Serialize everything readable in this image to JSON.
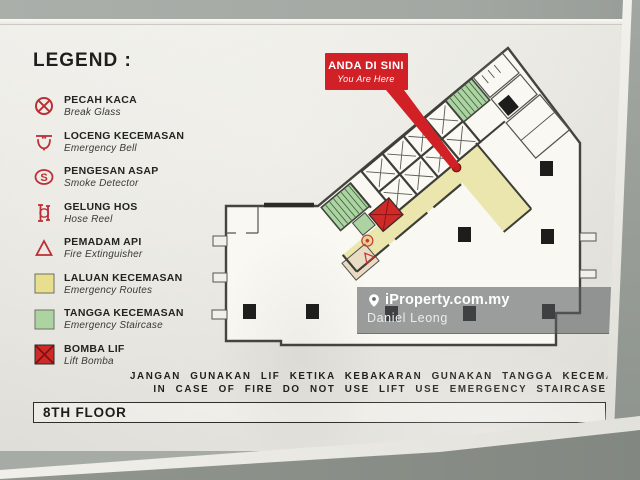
{
  "legend": {
    "heading": "LEGEND :",
    "items": [
      {
        "title": "PECAH KACA",
        "subtitle": "Break Glass",
        "icon": "break-glass-icon"
      },
      {
        "title": "LOCENG KECEMASAN",
        "subtitle": "Emergency Bell",
        "icon": "emergency-bell-icon"
      },
      {
        "title": "PENGESAN ASAP",
        "subtitle": "Smoke Detector",
        "icon": "smoke-detector-icon"
      },
      {
        "title": "GELUNG HOS",
        "subtitle": "Hose Reel",
        "icon": "hose-reel-icon"
      },
      {
        "title": "PEMADAM API",
        "subtitle": "Fire Extinguisher",
        "icon": "fire-extinguisher-icon"
      },
      {
        "title": "LALUAN KECEMASAN",
        "subtitle": "Emergency Routes",
        "icon": "emergency-route-swatch"
      },
      {
        "title": "TANGGA KECEMASAN",
        "subtitle": "Emergency Staircase",
        "icon": "emergency-staircase-swatch"
      },
      {
        "title": "BOMBA LIF",
        "subtitle": "Lift Bomba",
        "icon": "fire-lift-swatch"
      }
    ]
  },
  "callout": {
    "title": "ANDA DI SINI",
    "subtitle": "You Are Here"
  },
  "watermark": {
    "brand": "iProperty.com.my",
    "agent": "Daniel Leong"
  },
  "warning": {
    "line_malay": "JANGAN GUNAKAN LIF KETIKA KEBAKARAN GUNAKAN TANGGA KECEMASAN",
    "line_english": "IN CASE OF FIRE DO NOT USE LIFT USE EMERGENCY STAIRCASE"
  },
  "floor_label": "8TH FLOOR",
  "plan": {
    "type": "floor-plan",
    "features": [
      "lift-bank",
      "emergency-route-corridor",
      "emergency-staircase-upper",
      "emergency-staircase-lower",
      "fire-lift",
      "hose-reel-point",
      "fire-extinguisher-point",
      "you-are-here-marker",
      "structural-columns"
    ]
  },
  "colors": {
    "legend_red": "#bb2f36",
    "route_yellow": "#ebe5ae",
    "staircase_green": "#acd4a3",
    "fire_lift_red": "#cd2a28",
    "callout_red": "#d12026",
    "wall_dark": "#3e3e39"
  }
}
